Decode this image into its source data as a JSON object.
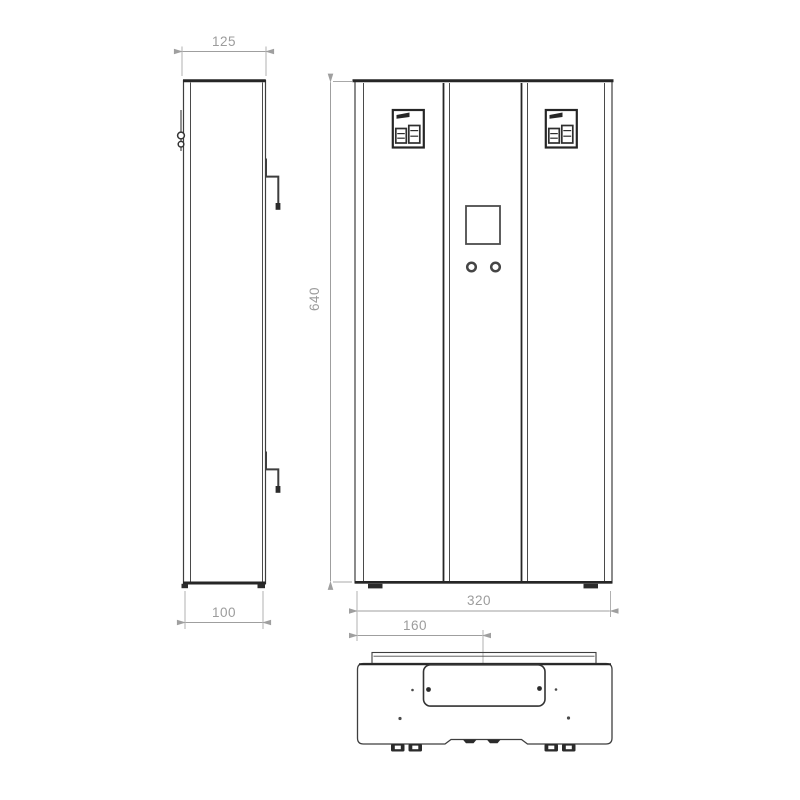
{
  "drawing": {
    "subject": "Electric boiler — three orthographic projection views (side, front, bottom)",
    "background_color": "#ffffff",
    "line_color": "#3e3e3e",
    "thick_line_color": "#262626",
    "dimension_color": "#9c9c9c",
    "dimensions": {
      "side_width_top": "125",
      "side_depth_bottom": "100",
      "front_height": "640",
      "front_width": "320",
      "bottom_center_offset": "160"
    }
  }
}
